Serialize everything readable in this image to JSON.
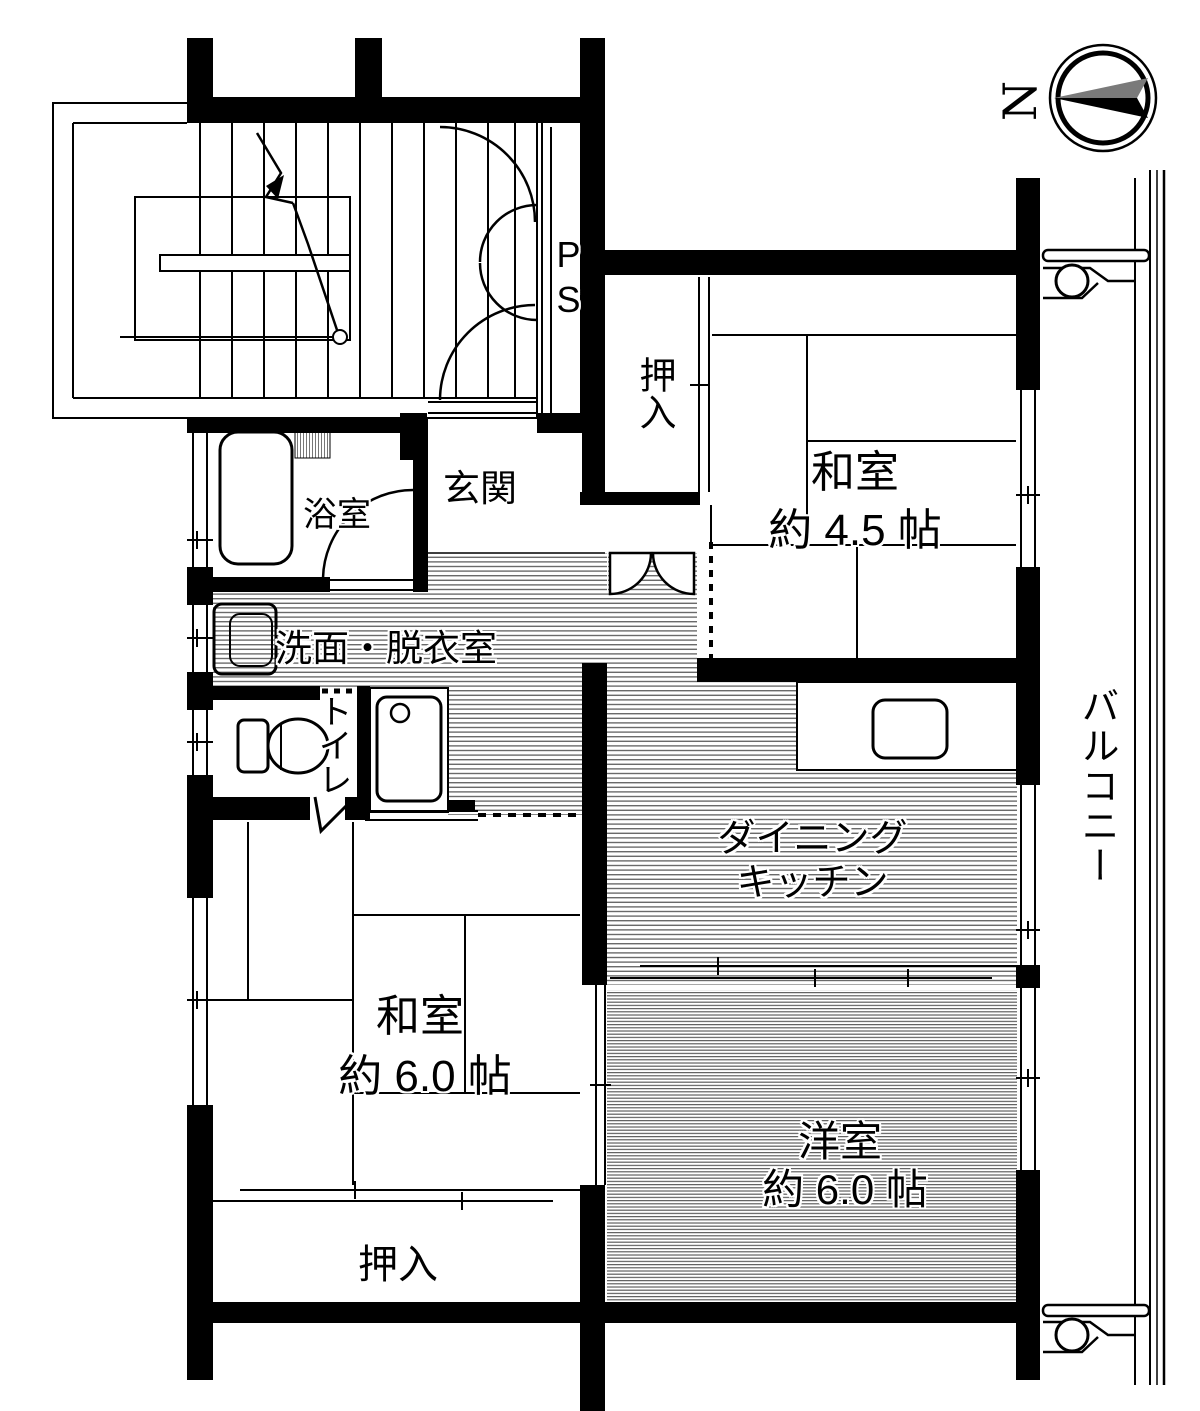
{
  "plan": {
    "compass_label": "N",
    "ps_label": "PS",
    "colors": {
      "wall": "#000000",
      "background": "#ffffff",
      "hatch": "#6a6a6a",
      "compass_gray": "#7a7a7a"
    }
  },
  "rooms": {
    "entrance": "玄関",
    "bathroom": "浴室",
    "washroom": "洗面・脱衣室",
    "toilet": "トイレ",
    "closet_upper": "押入",
    "closet_lower": "押入",
    "japanese_room_45": {
      "name": "和室",
      "size": "約 4.5 帖"
    },
    "dining_kitchen": {
      "line1": "ダイニング",
      "line2": "キッチン"
    },
    "japanese_room_6": {
      "name": "和室",
      "size": "約 6.0 帖"
    },
    "western_room_6": {
      "name": "洋室",
      "size": "約 6.0 帖"
    },
    "balcony": "バルコニー"
  }
}
